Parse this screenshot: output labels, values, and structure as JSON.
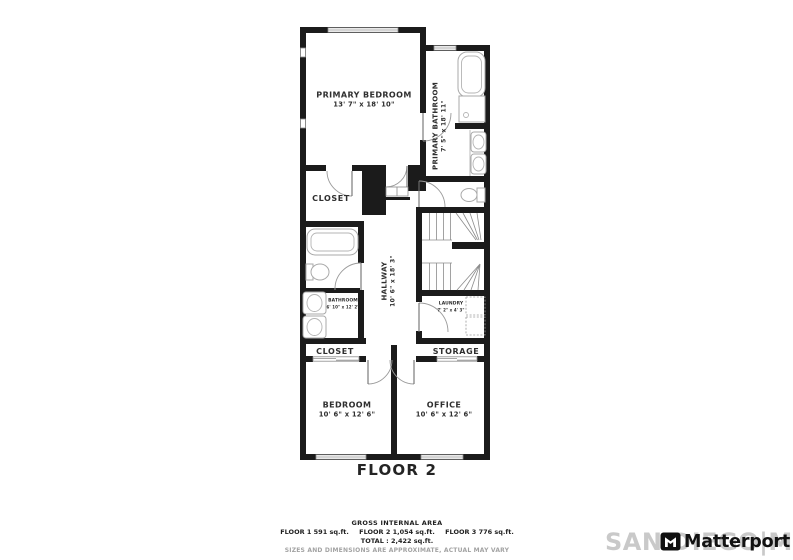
{
  "plan": {
    "floor_label": "FLOOR 2",
    "rooms": [
      {
        "name": "PRIMARY BEDROOM",
        "dims": "13' 7\" x 18' 10\""
      },
      {
        "name": "PRIMARY BATHROOM",
        "dims": "7' 5\" x 18' 11\""
      },
      {
        "name": "CLOSET",
        "dims": ""
      },
      {
        "name": "HALLWAY",
        "dims": "10' 6\" x 18' 3\""
      },
      {
        "name": "BATHROOM",
        "dims": "6' 10\" x 12' 2\""
      },
      {
        "name": "LAUNDRY",
        "dims": "7' 2\" x 4' 3\""
      },
      {
        "name": "CLOSET",
        "dims": ""
      },
      {
        "name": "STORAGE",
        "dims": ""
      },
      {
        "name": "BEDROOM",
        "dims": "10' 6\" x 12' 6\""
      },
      {
        "name": "OFFICE",
        "dims": "10' 6\" x 12' 6\""
      }
    ],
    "fixtures": [
      "bathtub",
      "shower",
      "double-sink",
      "toilet",
      "bathtub",
      "toilet",
      "double-sink",
      "washer",
      "dryer",
      "staircase",
      "closet-sliding-doors"
    ]
  },
  "footer": {
    "gross_area_title": "GROSS INTERNAL AREA",
    "floors": [
      "FLOOR 1 591 sq.ft.",
      "FLOOR 2 1,054 sq.ft.",
      "FLOOR 3 776 sq.ft."
    ],
    "total": "TOTAL :  2,422 sq.ft.",
    "disclaimer": "SIZES AND DIMENSIONS ARE APPROXIMATE, ACTUAL MAY VARY"
  },
  "branding": {
    "watermark": "SAN DIEGO|MLS",
    "logo_text": "Matterport"
  },
  "colors": {
    "wall": "#1b1b1b",
    "fixture_line": "#a9a9a9",
    "label_text": "#2f2f2f",
    "watermark_gray": "#c9c9c9",
    "logo_black": "#121212"
  }
}
